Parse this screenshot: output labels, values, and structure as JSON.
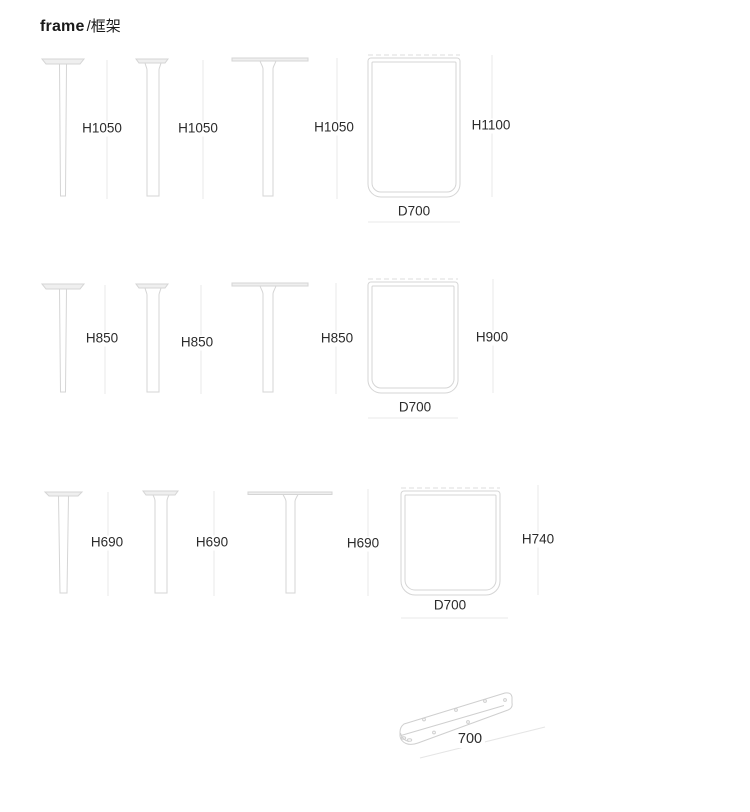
{
  "title": {
    "brand": "frame",
    "suffix": "/框架"
  },
  "rows": [
    {
      "name": "tall-frames",
      "legs": [
        {
          "label": "H1050"
        },
        {
          "label": "H1050"
        },
        {
          "label": "H1050"
        }
      ],
      "frame": {
        "height_label": "H1100",
        "depth_label": "D700"
      }
    },
    {
      "name": "medium-frames",
      "legs": [
        {
          "label": "H850"
        },
        {
          "label": "H850"
        },
        {
          "label": "H850"
        }
      ],
      "frame": {
        "height_label": "H900",
        "depth_label": "D700"
      }
    },
    {
      "name": "low-frames",
      "legs": [
        {
          "label": "H690"
        },
        {
          "label": "H690"
        },
        {
          "label": "H690"
        }
      ],
      "frame": {
        "height_label": "H740",
        "depth_label": "D700"
      }
    }
  ],
  "bracket": {
    "length_label": "700"
  },
  "colors": {
    "shape_line": "#d5d5d5",
    "shape_fill": "#efefef",
    "dimension_line": "#e9e9e9",
    "dashed_line": "#dcdcdc",
    "text": "#2b2b2b"
  }
}
